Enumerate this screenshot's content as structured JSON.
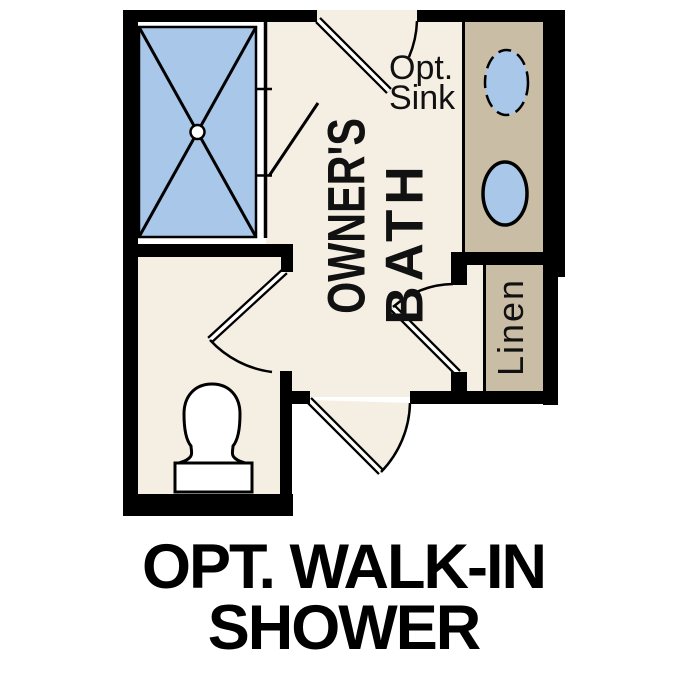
{
  "plan": {
    "room_label": {
      "line1": "OWNER'S",
      "line2": "BATH"
    },
    "opt_sink_label": {
      "line1": "Opt.",
      "line2": "Sink"
    },
    "linen_label": "Linen",
    "fixture_icons": [
      "shower-pan-icon",
      "shower-drain-icon",
      "shower-glass-door-icon",
      "toilet-icon",
      "sink-basin-icon",
      "optional-sink-basin-icon",
      "door-swing-icon",
      "vanity-counter-icon",
      "linen-shelf-icon"
    ]
  },
  "caption": {
    "line1": "OPT. WALK-IN",
    "line2": "SHOWER"
  },
  "colors": {
    "background": "#ffffff",
    "floor": "#f5eee2",
    "counter": "#c9bda6",
    "fixture_blue": "#a8c7e9",
    "wall": "#000000",
    "text": "#111111"
  }
}
